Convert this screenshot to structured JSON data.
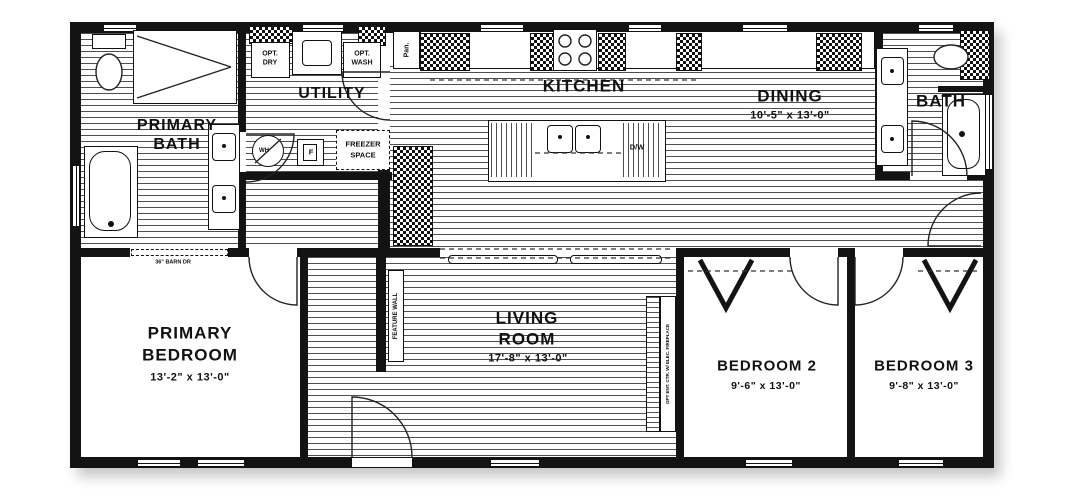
{
  "floor_plan": {
    "rooms": {
      "primary_bath": {
        "line1": "PRIMARY",
        "line2": "BATH"
      },
      "utility": {
        "label": "UTILITY"
      },
      "kitchen": {
        "label": "KITCHEN"
      },
      "dining": {
        "label": "DINING",
        "dims": "10'-5\" x  13'-0\""
      },
      "bath": {
        "label": "BATH"
      },
      "primary_bedroom": {
        "line1": "PRIMARY",
        "line2": "BEDROOM",
        "dims": "13'-2\" x  13'-0\""
      },
      "living_room": {
        "line1": "LIVING",
        "line2": "ROOM",
        "dims": "17'-8\" x  13'-0\""
      },
      "bedroom_2": {
        "label": "BEDROOM 2",
        "dims": "9'-6\" x  13'-0\""
      },
      "bedroom_3": {
        "label": "BEDROOM 3",
        "dims": "9'-8\" x  13'-0\""
      }
    },
    "annotations": {
      "opt_dry_line1": "OPT.",
      "opt_dry_line2": "DRY",
      "opt_wash_line1": "OPT.",
      "opt_wash_line2": "WASH",
      "freezer_line1": "FREEZER",
      "freezer_line2": "SPACE",
      "dishwasher": "D/W",
      "water_heater": "WH",
      "furnace": "F",
      "pantry": "Pan.",
      "feature_wall": "FEATURE WALL",
      "opt_ent_ctr": "OPT ENT. CTR. W/ ELEC. FIREPLACE",
      "barn_door": "36\" BARN DR"
    },
    "colors": {
      "wall": "#131313",
      "hatch_line": "#4f4f4f",
      "background": "#ffffff"
    }
  }
}
